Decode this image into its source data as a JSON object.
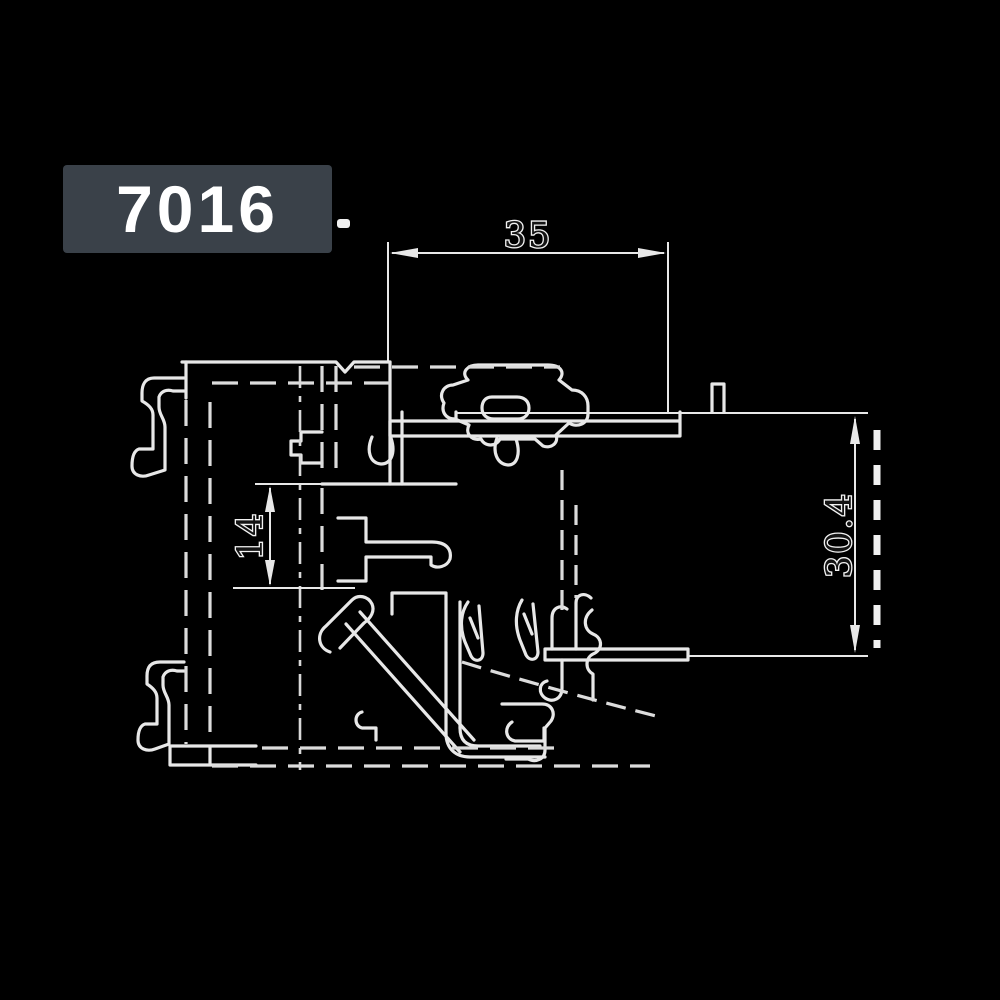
{
  "page": {
    "background_color": "#000000"
  },
  "badge": {
    "label": "7016",
    "background_color": "#3a4149",
    "text_color": "#ffffff"
  },
  "drawing": {
    "description": "Aluminium window frame profile cross-section, white CAD line art on black",
    "line_color": "#e8e8e8",
    "dimensions": {
      "top_width": {
        "value": "35",
        "orientation": "horizontal"
      },
      "right_height": {
        "value": "30.4",
        "orientation": "vertical"
      },
      "inner_height": {
        "value": "14",
        "orientation": "vertical"
      }
    }
  }
}
